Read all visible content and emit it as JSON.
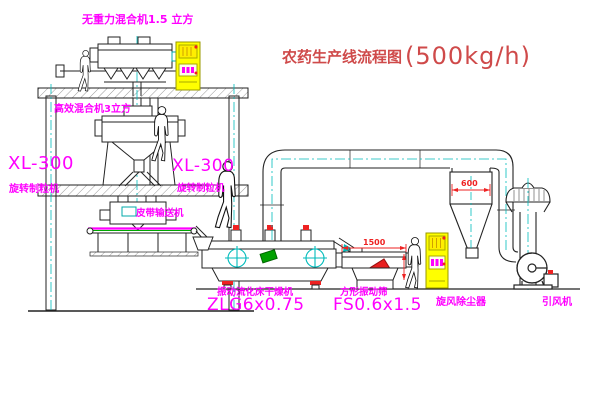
{
  "title": {
    "name": "农药生产线流程图",
    "capacity": "(500kg/h)"
  },
  "equipment_labels": {
    "gravity_free_mixer": "无重力混合机1.5 立方",
    "high_efficiency_mixer": "高效混合机3立方",
    "granulator_left": {
      "model": "XL-300",
      "name": "旋转制粒机"
    },
    "granulator_right": {
      "model": "XL-300",
      "name": "旋转制粒机"
    },
    "belt_conveyor": "皮带输送机",
    "fluid_bed_dryer": {
      "name": "振动流化床干燥机",
      "model": "ZLG6x0.75"
    },
    "square_vibrating_sieve": {
      "name": "方形振动筛",
      "model": "FS0.6x1.5"
    },
    "cyclone_dust_collector": "旋风除尘器",
    "induced_draft_fan": "引风机"
  },
  "dimension_annotations": {
    "cyclone_width": "600",
    "sieve_length": "1500"
  },
  "colors": {
    "background": "#ffffff",
    "line_black": "#222222",
    "centerline_cyan": "#00bbbb",
    "label_magenta": "#ff00ff",
    "dimension_red": "#ee2222",
    "title_red": "#cf4a4a",
    "cabinet_yellow": "#ffff00",
    "accent_green": "#00a000"
  }
}
